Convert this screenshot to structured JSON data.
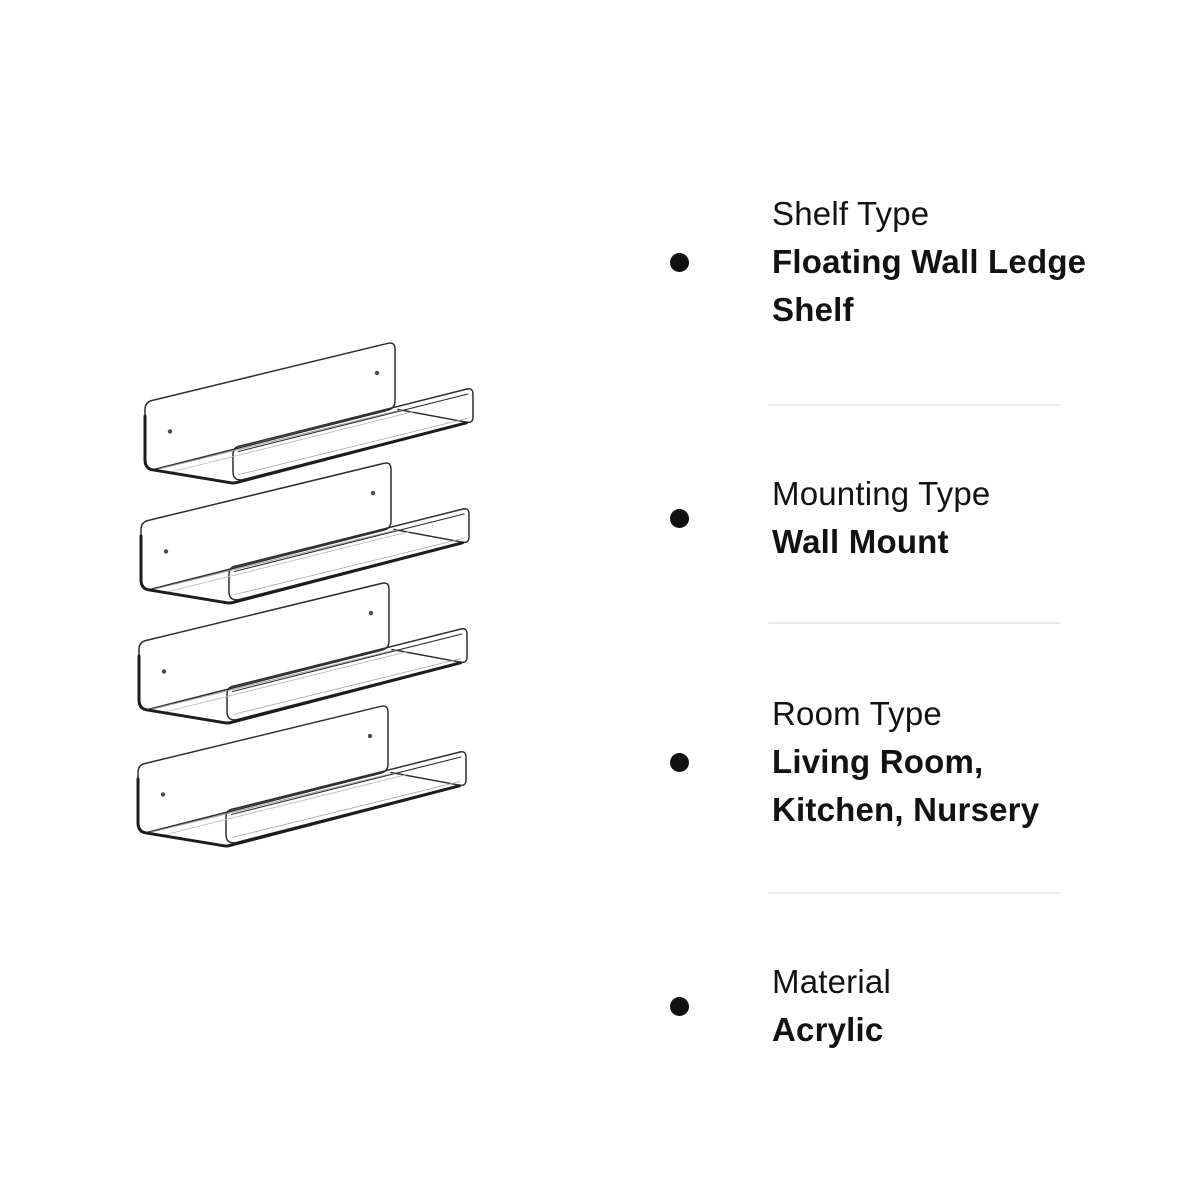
{
  "figure": {
    "name": "acrylic-floating-shelf-line-drawing",
    "shelf_count": 4
  },
  "features": [
    {
      "label": "Shelf Type",
      "value": "Floating Wall Ledge\nShelf"
    },
    {
      "label": "Mounting Type",
      "value": "Wall Mount"
    },
    {
      "label": "Room Type",
      "value": "Living Room,\nKitchen, Nursery"
    },
    {
      "label": "Material",
      "value": "Acrylic"
    }
  ],
  "style": {
    "background": "#ffffff",
    "text_color": "#101214",
    "bullet_color": "#111111",
    "divider_color": "#e9e9e9",
    "drawing_line_color": "#2f2f2f",
    "drawing_heavy_line_color": "#1c1c1c"
  }
}
